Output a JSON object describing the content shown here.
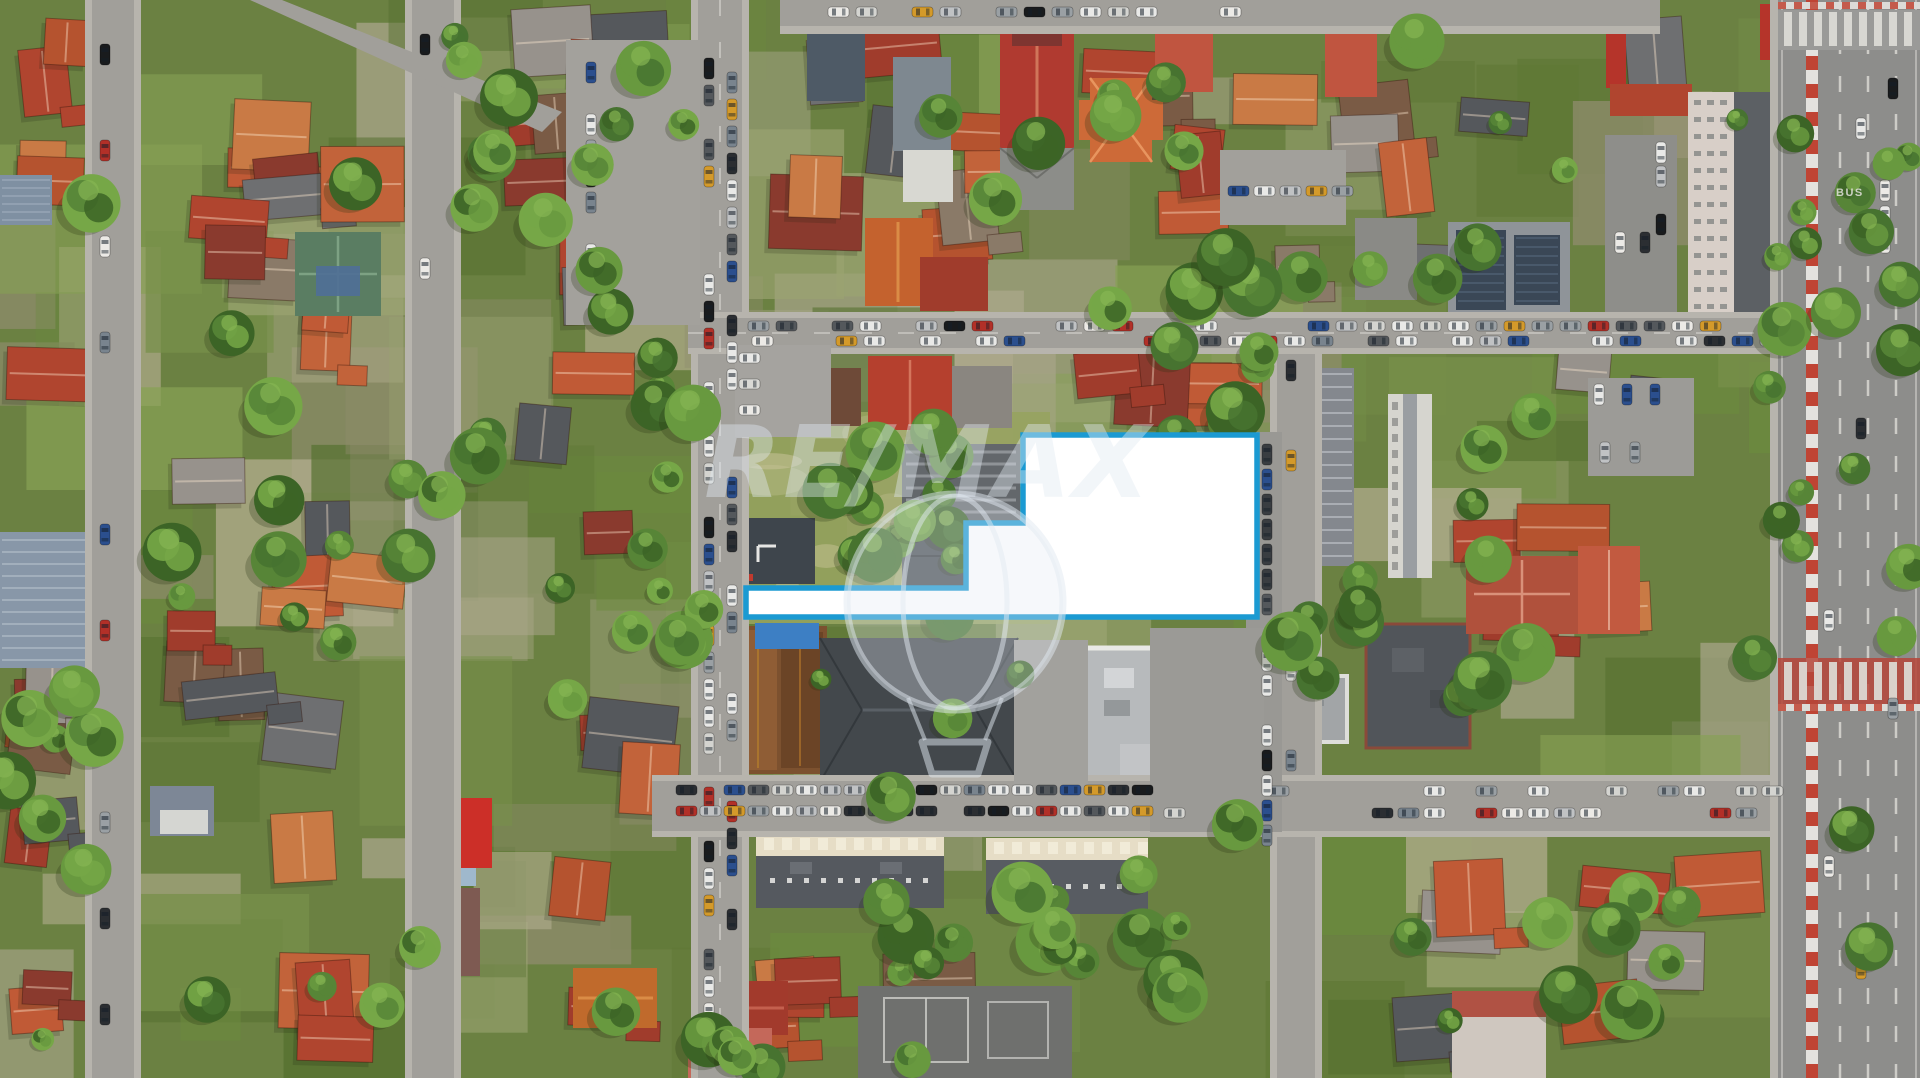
{
  "image": {
    "kind": "aerial drone photograph",
    "subject": "residential district with highlighted land parcel for sale",
    "width_px": 1920,
    "height_px": 1078
  },
  "watermark": {
    "text": "RE/MAX",
    "icon": "hot-air-balloon-icon",
    "color": "#e2eaf2",
    "text_opacity": 0.42,
    "balloon_fill_opacity": 0.32,
    "balloon_stroke_opacity": 0.5
  },
  "highlight": {
    "label": "listed parcel boundary",
    "points": "1023,435 1257,435 1257,617 746,617 746,588 966,588 966,523 1023,523",
    "fill": "#ffffff",
    "stroke": "#1b9ad2",
    "stroke_width": 5.5
  },
  "boulevard": {
    "bus_marking": "BUS"
  },
  "palette": {
    "grass_base": "#6b8142",
    "ground_patches": [
      "#5f7836",
      "#77904a",
      "#86a054",
      "#55702f",
      "#6b8a3e",
      "#9aa371",
      "#8f8c6d",
      "#a7a488",
      "#b3ad8f"
    ],
    "dry_grass": "#97a35f",
    "roof_colors": [
      "#b5532f",
      "#c2633a",
      "#a03c2c",
      "#8a3a2e",
      "#c97a45",
      "#b0452f",
      "#8a7a68",
      "#97928c",
      "#6e6f71",
      "#55585c",
      "#7a5b45",
      "#c05a36"
    ],
    "road": "#a19f9a",
    "road_dark": "#989793",
    "sidewalk": "#b7b4ad",
    "asphalt": "#8d8d8b",
    "marking_white": "#dddcd7",
    "crosswalk_red": "#b5453a",
    "median_red": "#bf4434",
    "tree_greens": [
      "#3c6426",
      "#477330",
      "#578537",
      "#68993f",
      "#76a747"
    ],
    "tree_highlight": "#86b553",
    "tree_shadow": "#22300f",
    "car_colors": [
      "#e9e9e7",
      "#e9e9e7",
      "#e9e9e7",
      "#d4d4d0",
      "#c0c2c4",
      "#2b2e32",
      "#54585c",
      "#b23028",
      "#2b4f8e",
      "#d49a2a",
      "#191b1d",
      "#79848e",
      "#eceae6",
      "#9aa0a4"
    ],
    "car_dark": [
      "#2b2e32",
      "#393d41",
      "#54585c",
      "#23262a",
      "#2b4f8e"
    ]
  }
}
